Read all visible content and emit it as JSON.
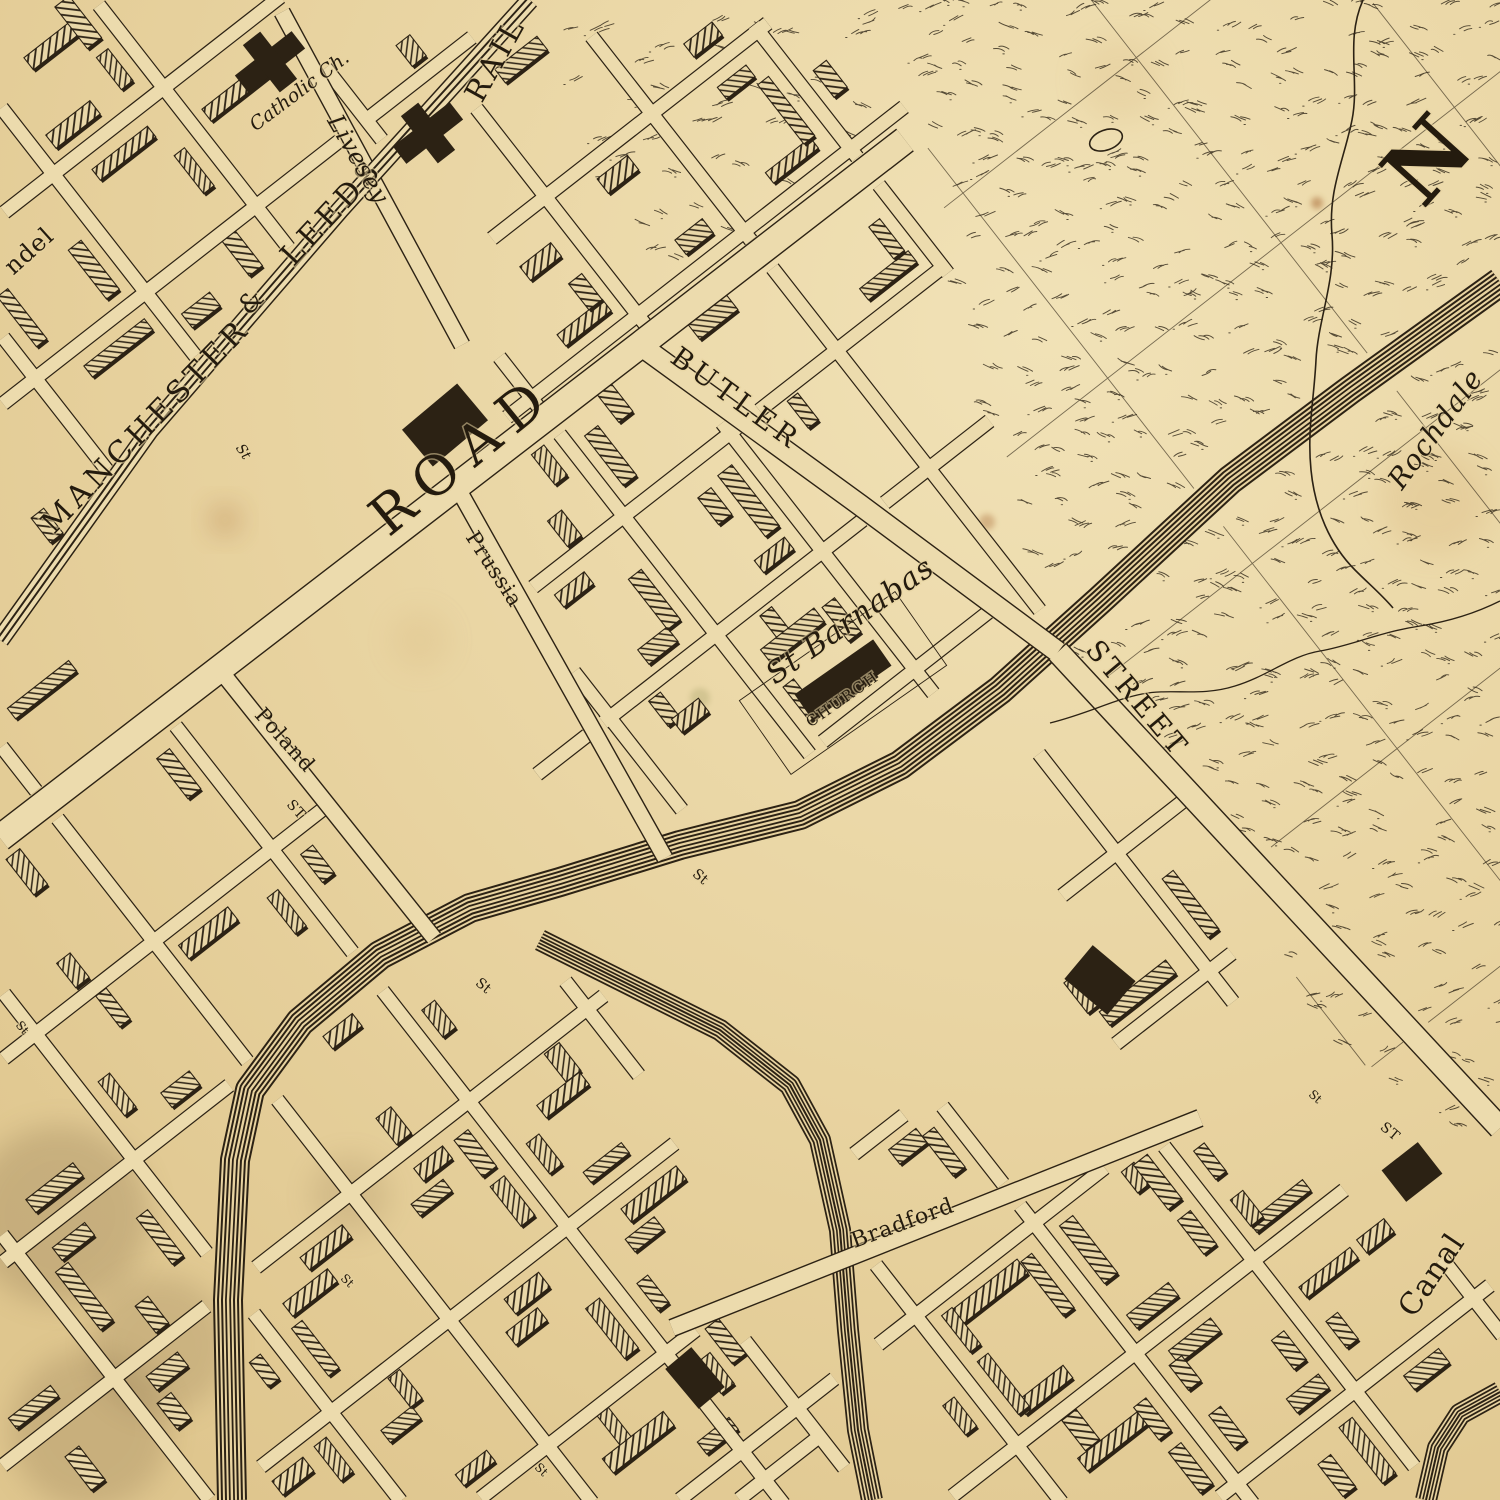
{
  "map": {
    "kind": "antique engraved street map",
    "palette": {
      "paper": "#e8d3a0",
      "paper_light": "#f0e1b6",
      "road_fill": "#ecdbad",
      "hatch_bg": "#e9d7a8",
      "ink": "#2c2214",
      "label_ink": "#241b0e",
      "stain_rust": "#a3622e",
      "stain_soot": "#6e5638"
    },
    "compass": {
      "letter": "N"
    },
    "labels": [
      {
        "id": "railway-name-1",
        "text": "MANCHESTER",
        "x": 147,
        "y": 427,
        "rot": -46,
        "size": 30,
        "ls": 5,
        "cls": ""
      },
      {
        "id": "railway-name-2",
        "text": "&",
        "x": 252,
        "y": 303,
        "rot": -46,
        "size": 26,
        "ls": 0,
        "cls": ""
      },
      {
        "id": "railway-name-3",
        "text": "LEEDS",
        "x": 333,
        "y": 213,
        "rot": -47,
        "size": 30,
        "ls": 5,
        "cls": ""
      },
      {
        "id": "railway-name-4",
        "text": "RAIL",
        "x": 497,
        "y": 60,
        "rot": -61,
        "size": 30,
        "ls": 4,
        "cls": ""
      },
      {
        "id": "road-label",
        "text": "ROAD",
        "x": 465,
        "y": 458,
        "rot": -39,
        "size": 54,
        "ls": 13,
        "cls": ""
      },
      {
        "id": "butler-street",
        "text": "BUTLER",
        "x": 735,
        "y": 400,
        "rot": 36,
        "size": 28,
        "ls": 5,
        "cls": ""
      },
      {
        "id": "st-barnabas",
        "text": "St Barnabas",
        "x": 851,
        "y": 622,
        "rot": -35,
        "size": 30,
        "ls": 1,
        "cls": "it"
      },
      {
        "id": "st-barnabas-church",
        "text": "CHURCH",
        "x": 843,
        "y": 700,
        "rot": -35,
        "size": 15,
        "ls": 2,
        "cls": ""
      },
      {
        "id": "street-label",
        "text": "STREET",
        "x": 1136,
        "y": 700,
        "rot": 50,
        "size": 28,
        "ls": 4,
        "cls": ""
      },
      {
        "id": "rochdale-canal",
        "text": "Rochdale",
        "x": 1437,
        "y": 430,
        "rot": -54,
        "size": 28,
        "ls": 1,
        "cls": "it"
      },
      {
        "id": "compass-n",
        "text": "N",
        "x": 1433,
        "y": 165,
        "rot": -48,
        "size": 88,
        "ls": 0,
        "cls": "bold"
      },
      {
        "id": "livesey-street",
        "text": "Livesey",
        "x": 357,
        "y": 160,
        "rot": 60,
        "size": 24,
        "ls": 1,
        "cls": "it"
      },
      {
        "id": "catholic-chapel",
        "text": "Catholic Ch.",
        "x": 300,
        "y": 92,
        "rot": -37,
        "size": 19,
        "ls": 0,
        "cls": "it"
      },
      {
        "id": "ndel-fragment",
        "text": "ndel",
        "x": 30,
        "y": 252,
        "rot": -42,
        "size": 24,
        "ls": 1,
        "cls": ""
      },
      {
        "id": "prussia-street",
        "text": "Prussia",
        "x": 493,
        "y": 570,
        "rot": 57,
        "size": 21,
        "ls": 1,
        "cls": ""
      },
      {
        "id": "poland-street",
        "text": "Poland",
        "x": 284,
        "y": 741,
        "rot": 48,
        "size": 21,
        "ls": 1,
        "cls": ""
      },
      {
        "id": "poland-st-suffix",
        "text": "ST",
        "x": 296,
        "y": 810,
        "rot": 48,
        "size": 14,
        "ls": 1,
        "cls": ""
      },
      {
        "id": "bradford-street",
        "text": "Bradford",
        "x": 903,
        "y": 1224,
        "rot": -20,
        "size": 22,
        "ls": 1,
        "cls": ""
      },
      {
        "id": "canal-label",
        "text": "Canal",
        "x": 1433,
        "y": 1276,
        "rot": -56,
        "size": 30,
        "ls": 1,
        "cls": ""
      },
      {
        "id": "st-1",
        "text": "St",
        "x": 243,
        "y": 452,
        "rot": 55,
        "size": 14,
        "ls": 0,
        "cls": "it"
      },
      {
        "id": "st-2",
        "text": "St",
        "x": 700,
        "y": 877,
        "rot": 40,
        "size": 14,
        "ls": 0,
        "cls": ""
      },
      {
        "id": "st-3",
        "text": "St",
        "x": 483,
        "y": 986,
        "rot": 40,
        "size": 14,
        "ls": 0,
        "cls": ""
      },
      {
        "id": "st-4",
        "text": "ST",
        "x": 1390,
        "y": 1132,
        "rot": 40,
        "size": 14,
        "ls": 1,
        "cls": ""
      },
      {
        "id": "st-5",
        "text": "St",
        "x": 1315,
        "y": 1097,
        "rot": 42,
        "size": 12,
        "ls": 0,
        "cls": ""
      },
      {
        "id": "st-6",
        "text": "St",
        "x": 347,
        "y": 1281,
        "rot": 45,
        "size": 12,
        "ls": 0,
        "cls": ""
      },
      {
        "id": "st-7",
        "text": "St",
        "x": 22,
        "y": 1028,
        "rot": 50,
        "size": 12,
        "ls": 0,
        "cls": ""
      },
      {
        "id": "st-8",
        "text": "St",
        "x": 541,
        "y": 1470,
        "rot": 45,
        "size": 12,
        "ls": 0,
        "cls": ""
      }
    ]
  }
}
